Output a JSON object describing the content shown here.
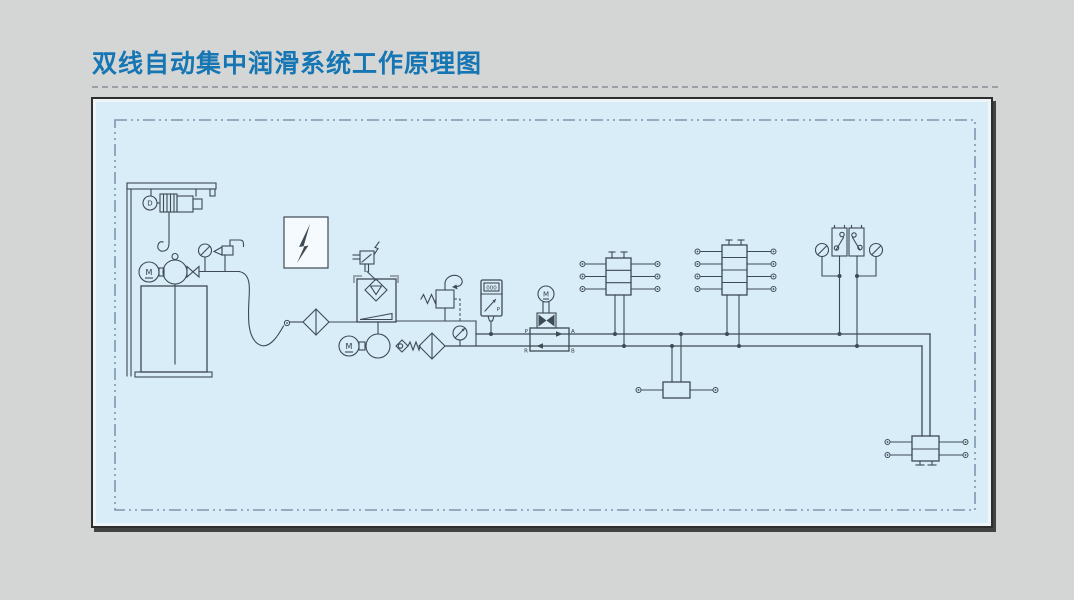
{
  "title": "双线自动集中润滑系统工作原理图",
  "colors": {
    "background": "#d4d5d5",
    "title_blue": "#1576b3",
    "panel_fill": "#d8edf8",
    "panel_border": "#2e2e2e",
    "inner_dashed_border": "#7f96ad",
    "schematic_line": "#3e4a54",
    "bracket_grey": "#9aa5ad"
  },
  "labels": {
    "hoist_motor": "D",
    "fill_pump_motor": "M",
    "station_pump_motor": "M",
    "reversing_valve_motor": "M",
    "valve_port_p": "P",
    "valve_port_a": "A",
    "valve_port_r": "R",
    "valve_port_b": "B",
    "contact_gauge_display": "000",
    "contact_gauge_unit": "P"
  }
}
